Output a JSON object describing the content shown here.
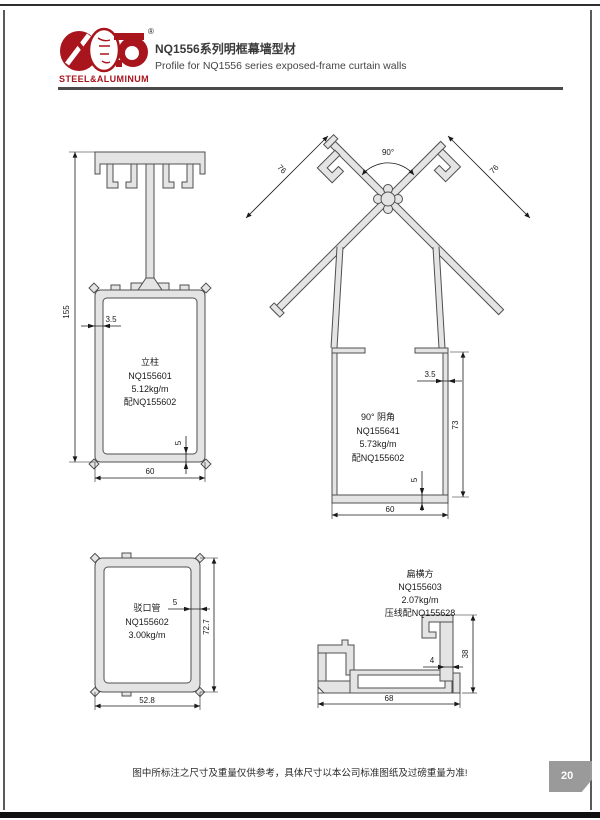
{
  "header": {
    "brand": "STEEL&ALUMINUM",
    "reg_mark": "®",
    "title_zh": "NQ1556系列明框幕墙型材",
    "title_en": "Profile for NQ1556 series exposed-frame curtain walls",
    "accent_color": "#a8151d"
  },
  "profiles": {
    "mullion": {
      "label_zh": "立柱",
      "code": "NQ155601",
      "weight": "5.12kg/m",
      "match": "配NQ155602",
      "dims": {
        "height": "155",
        "wall": "3.5",
        "width": "60",
        "base": "5"
      }
    },
    "corner": {
      "label_zh": "90° 阴角",
      "code": "NQ155641",
      "weight": "5.73kg/m",
      "match": "配NQ155602",
      "dims": {
        "angle": "90°",
        "arm_left": "76",
        "arm_right": "76",
        "wall": "3.5",
        "height": "73",
        "width": "60",
        "base": "5"
      }
    },
    "spigot": {
      "label_zh": "驳口管",
      "code": "NQ155602",
      "weight": "3.00kg/m",
      "dims": {
        "wall": "5",
        "height": "72.7",
        "width": "52.8"
      }
    },
    "transom": {
      "label_zh": "扁横方",
      "code": "NQ155603",
      "weight": "2.07kg/m",
      "match": "压线配NQ155628",
      "dims": {
        "width": "68",
        "height": "38",
        "wall": "4"
      }
    }
  },
  "page": {
    "footer_note": "图中所标注之尺寸及重量仅供参考，具体尺寸以本公司标准图纸及过磅重量为准!",
    "page_number": "20"
  }
}
